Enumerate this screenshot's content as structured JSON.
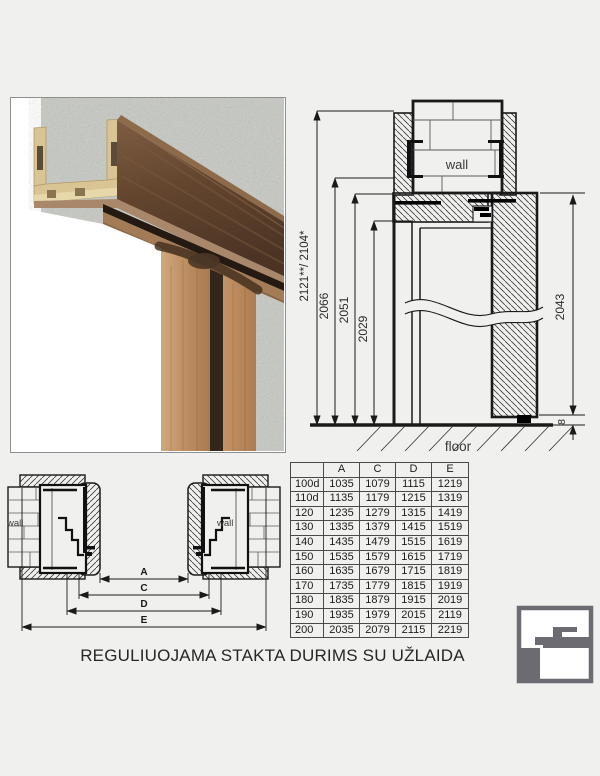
{
  "title": {
    "text": "REGULIUOJAMA STAKTA DURIMS SU UŽLAIDA"
  },
  "vertical_section": {
    "wall_label": "wall",
    "floor_label": "floor",
    "dim_total": "2121**/ 2104*",
    "dim_frame_outer": "2066",
    "dim_frame_inner": "2051",
    "dim_opening": "2029",
    "dim_leaf": "2043",
    "dim_floor_gap": "8"
  },
  "plan_section": {
    "wall_label_left": "wall",
    "wall_label_right": "wall",
    "dim_a": "A",
    "dim_c": "C",
    "dim_d": "D",
    "dim_e": "E"
  },
  "size_table": {
    "headers": [
      "",
      "A",
      "C",
      "D",
      "E"
    ],
    "rows": [
      [
        "100d",
        "1035",
        "1079",
        "1115",
        "1219"
      ],
      [
        "110d",
        "1135",
        "1179",
        "1215",
        "1319"
      ],
      [
        "120",
        "1235",
        "1279",
        "1315",
        "1419"
      ],
      [
        "130",
        "1335",
        "1379",
        "1415",
        "1519"
      ],
      [
        "140",
        "1435",
        "1479",
        "1515",
        "1619"
      ],
      [
        "150",
        "1535",
        "1579",
        "1615",
        "1719"
      ],
      [
        "160",
        "1635",
        "1679",
        "1715",
        "1819"
      ],
      [
        "170",
        "1735",
        "1779",
        "1815",
        "1919"
      ],
      [
        "180",
        "1835",
        "1879",
        "1915",
        "2019"
      ],
      [
        "190",
        "1935",
        "1979",
        "2015",
        "2119"
      ],
      [
        "200",
        "2035",
        "2079",
        "2115",
        "2219"
      ]
    ]
  },
  "colors": {
    "background": "#f0f0ee",
    "drawing_line": "#1a1a1a",
    "concrete_gray": "#c6c8c2",
    "wood_frame_light": "#d9c493",
    "wood_walnut_dark": "#5e4230",
    "wood_oak": "#c0946a",
    "seal_black": "#241a11",
    "logo_gray": "#6b6b71",
    "table_border": "#4a4a4a",
    "text_dark": "#262626"
  }
}
